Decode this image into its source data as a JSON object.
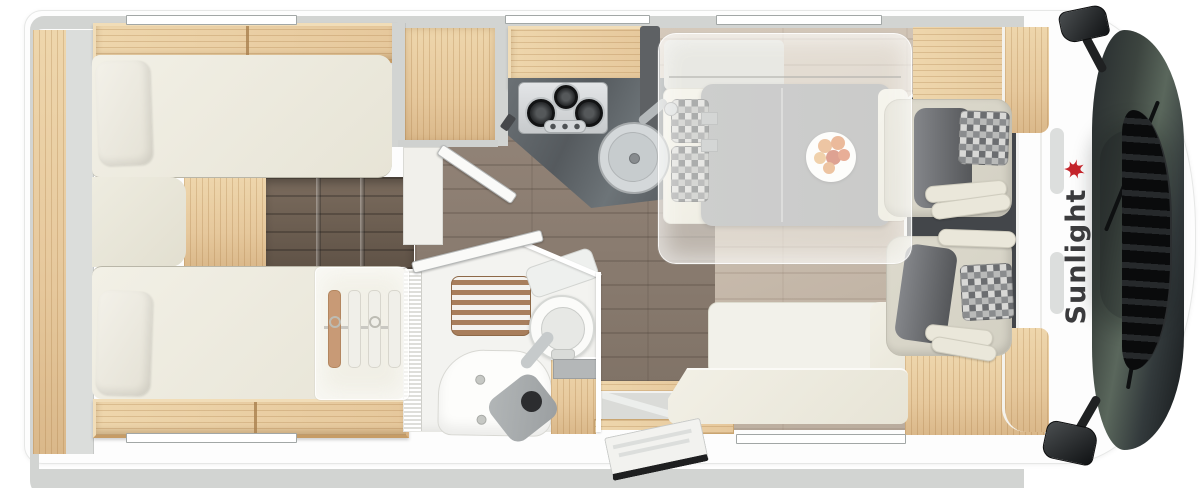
{
  "brand": {
    "logo_text": "Sunlight",
    "logo_icon": "sunlight-palm-icon"
  },
  "features": {
    "rear_single_beds": 2,
    "bed_pillows": 2,
    "wardrobe_hangers": 4,
    "hob_burners": 3,
    "hob_control_knobs": 3,
    "kitchen_sink": 1,
    "bathroom_toilet": 1,
    "shower_mat_slats": 6,
    "dinette_plate_fruits": 6,
    "cab_seats": 2,
    "side_mirrors": 2,
    "wall_windows": 5,
    "entry_door": 1,
    "drop_down_bed_overlay": 1
  },
  "icons": {
    "logo": "sunlight-palm-icon",
    "hangers": "clothes-hanger-icon",
    "burners": "gas-burner-icon",
    "sink": "round-sink-icon",
    "toilet": "toilet-icon",
    "mirrors": "side-mirror-icon"
  },
  "colors": {
    "body_white": "#fdfdfd",
    "wall": "#d2d4d2",
    "oak": "#e6c89c",
    "oak_light": "#eed6ac",
    "oak_dark": "#c69c66",
    "cream": "#e7e4d6",
    "pillow": "#f3f1e9",
    "rail": "#dbdddb",
    "floor_dark": "#8b7d70",
    "floor_steps": "#6e6052",
    "floor_light": "#c9bcae",
    "counter_a": "#555a5e",
    "counter_b": "#585d61",
    "table": "#a3a4a6",
    "mat": "#43464a",
    "seat_cream": "#d3d0c3",
    "seat_gray": "#55575a",
    "frost": "rgba(250,250,246,0.45)",
    "chk_a": "#6b6d70",
    "chk_b": "#b9bab9",
    "chk_c": "#8a8c8e",
    "chk_d": "#d8d8d6",
    "glass_a": "#262b2e",
    "glass_b": "#15181a",
    "glass_c": "#5a675c",
    "grille_a": "#0a0b0c",
    "grille_b": "#26292b",
    "window": "#ffffff",
    "logo_red": "#c4242b",
    "logo_ink": "#3b3b3d",
    "fruit_orange": "#e29a60",
    "fruit_red": "#c75940",
    "fruit_yellow": "#e8b06d"
  }
}
